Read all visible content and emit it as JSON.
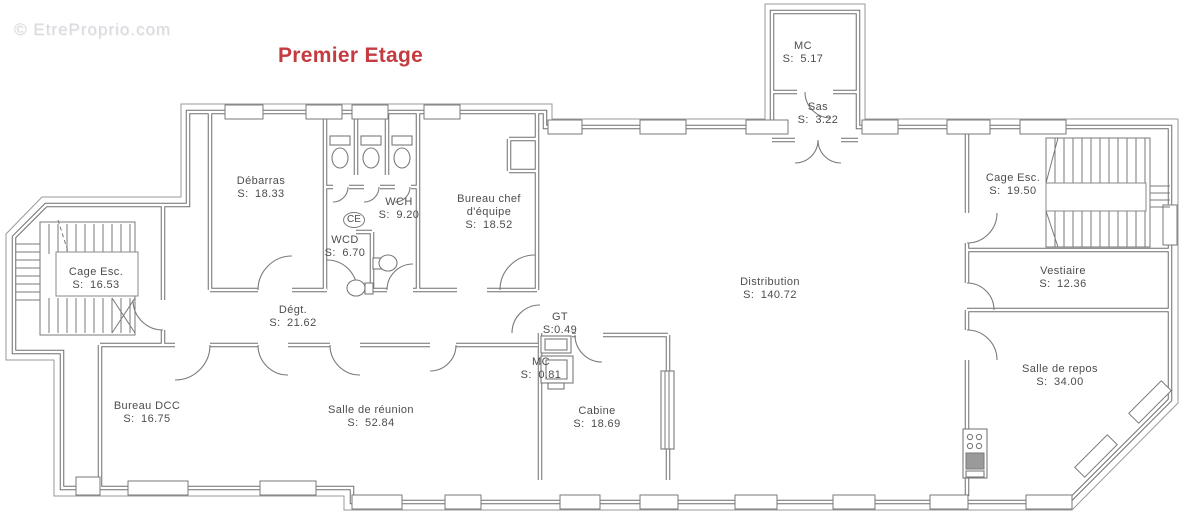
{
  "watermark": "© EtreProprio.com",
  "title": "Premier Etage",
  "colors": {
    "title_red": "#c43b40",
    "wall_gray": "#6e6e6e",
    "label_gray": "#4d4d4d",
    "watermark_gray": "#d9d9de",
    "background": "#ffffff"
  },
  "rooms": {
    "mc_top": {
      "name": "MC",
      "area": "S: 5.17"
    },
    "sas": {
      "name": "Sas",
      "area": "S: 3.22"
    },
    "debarras": {
      "name": "Débarras",
      "area": "S: 18.33"
    },
    "wch": {
      "name": "WCH",
      "area": "S: 9.20"
    },
    "wcd": {
      "name": "WCD",
      "area": "S: 6.70"
    },
    "ce": {
      "name": "CE"
    },
    "bureau_chef": {
      "name": "Bureau chef d'équipe",
      "area": "S: 18.52"
    },
    "cage_esc_droite": {
      "name": "Cage Esc.",
      "area": "S: 19.50"
    },
    "vestiaire": {
      "name": "Vestiaire",
      "area": "S: 12.36"
    },
    "distribution": {
      "name": "Distribution",
      "area": "S: 140.72"
    },
    "cage_esc_gauche": {
      "name": "Cage Esc.",
      "area": "S: 16.53"
    },
    "degagement": {
      "name": "Dégt.",
      "area": "S: 21.62"
    },
    "gt": {
      "name": "GT",
      "area": "S:0.49"
    },
    "mc_petit": {
      "name": "MC",
      "area": "S: 0.81"
    },
    "bureau_dcc": {
      "name": "Bureau DCC",
      "area": "S: 16.75"
    },
    "salle_reunion": {
      "name": "Salle de réunion",
      "area": "S: 52.84"
    },
    "cabine": {
      "name": "Cabine",
      "area": "S: 18.69"
    },
    "salle_repos": {
      "name": "Salle de repos",
      "area": "S: 34.00"
    }
  }
}
